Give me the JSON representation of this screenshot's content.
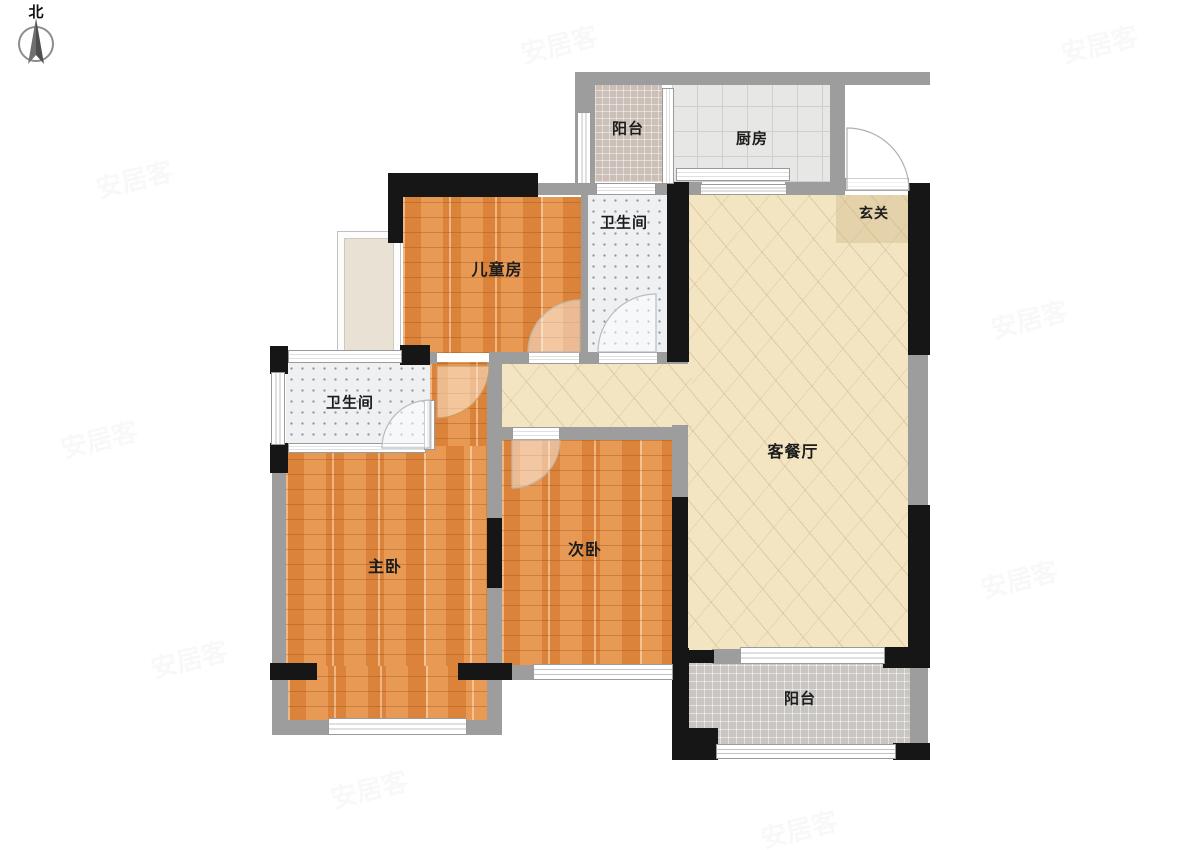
{
  "compass": {
    "north_label": "北"
  },
  "watermark": {
    "text": "安居客"
  },
  "rooms": {
    "balcony_top": {
      "label": "阳台"
    },
    "kitchen": {
      "label": "厨房"
    },
    "entry": {
      "label": "玄关"
    },
    "bath_top": {
      "label": "卫生间"
    },
    "children_room": {
      "label": "儿童房"
    },
    "living_dining": {
      "label": "客餐厅"
    },
    "bath_left": {
      "label": "卫生间"
    },
    "master_bedroom": {
      "label": "主卧"
    },
    "second_bedroom": {
      "label": "次卧"
    },
    "balcony_bottom": {
      "label": "阳台"
    }
  },
  "colors": {
    "wall_black": "#161616",
    "wall_gray": "#9d9d9d",
    "wood": "#e08a41",
    "living": "#f3e4c2",
    "bath": "#eef0f2",
    "kitchen": "#e7e7e5",
    "balcony_top": "#cbbfb8",
    "balcony_bottom": "#c9c5c1"
  }
}
